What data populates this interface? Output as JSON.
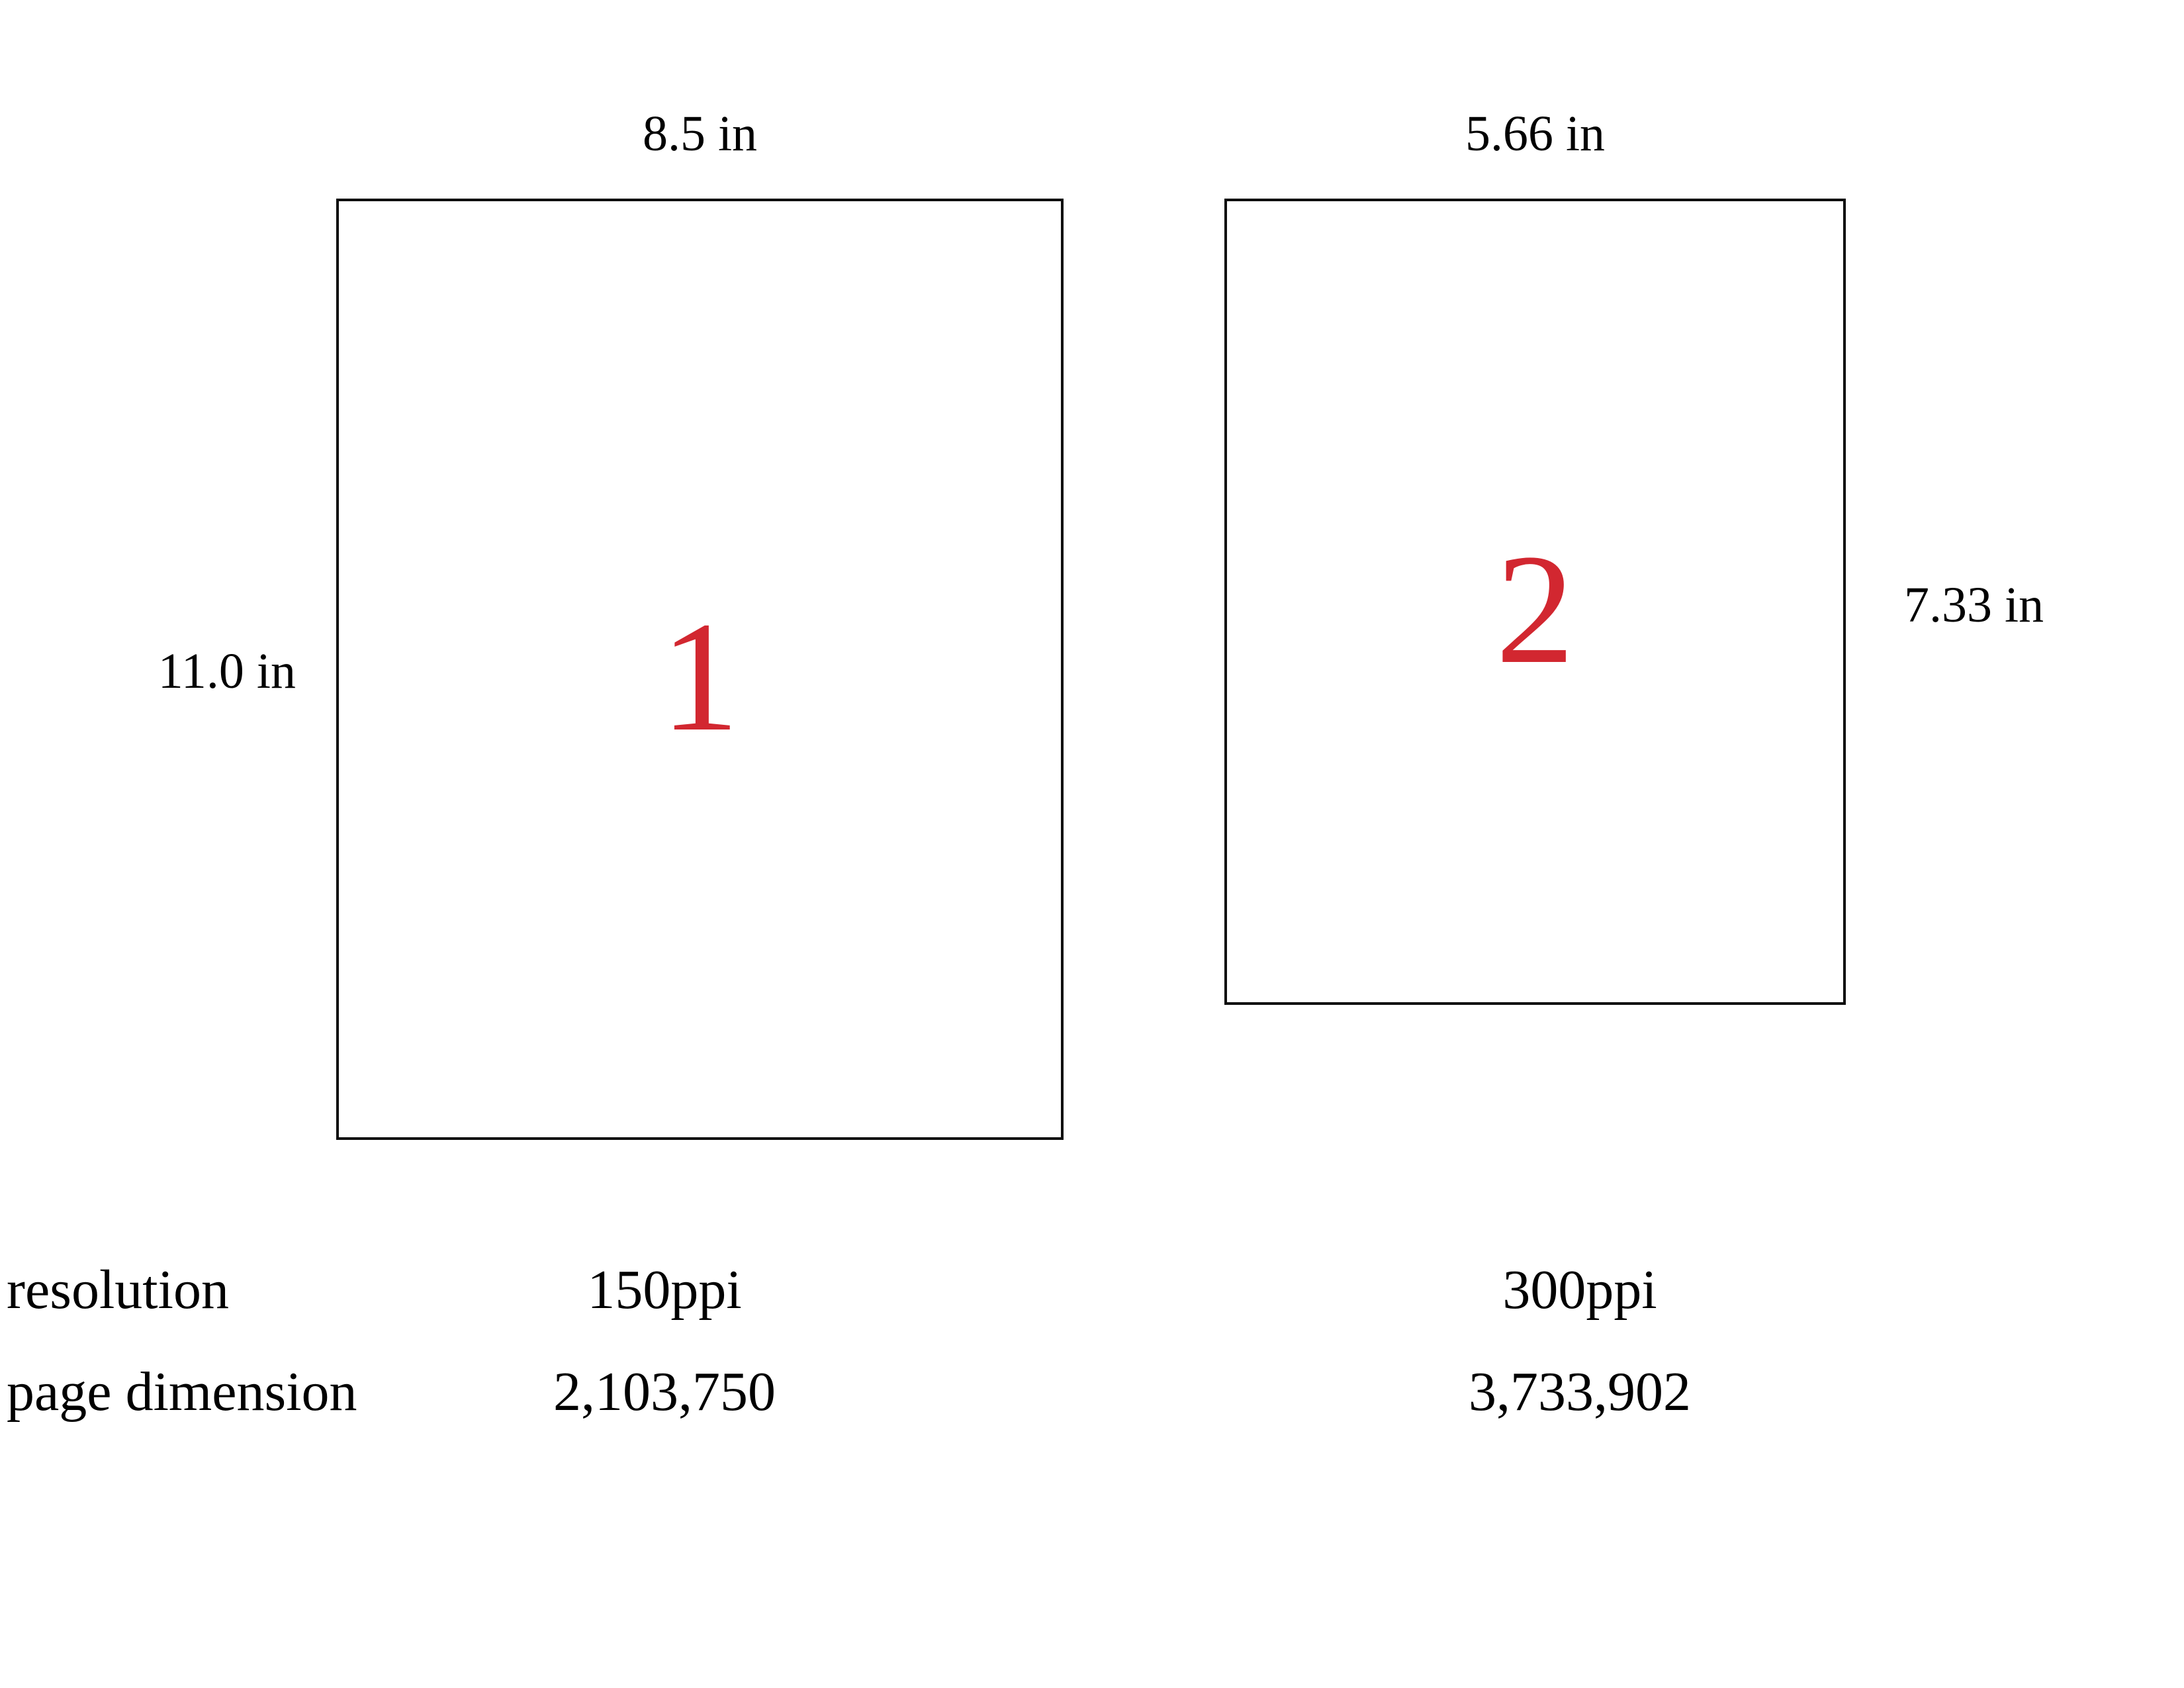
{
  "colors": {
    "accent_red": "#d22730",
    "ink": "#000000",
    "line": "#0c0c0c"
  },
  "figure": {
    "pages": [
      {
        "number": "1",
        "width_label": "8.5 in",
        "height_label": "11.0 in",
        "resolution": "150ppi",
        "page_dimension": "2,103,750"
      },
      {
        "number": "2",
        "width_label": "5.66 in",
        "height_label": "7.33 in",
        "resolution": "300ppi",
        "page_dimension": "3,733,902"
      }
    ],
    "rows": {
      "resolution_label": "resolution",
      "page_dimension_label": "page dimension"
    }
  }
}
